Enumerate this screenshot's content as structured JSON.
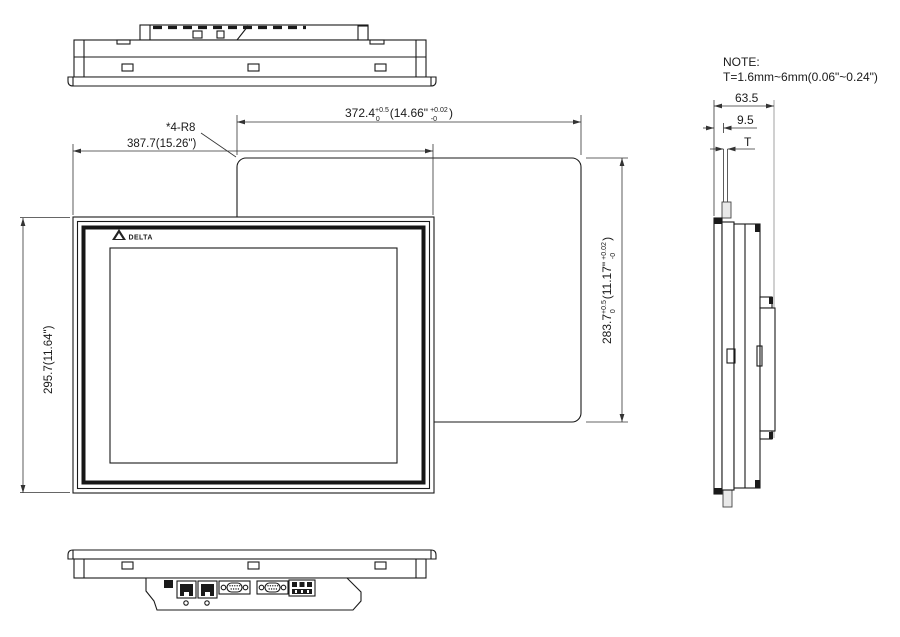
{
  "colors": {
    "line": "#1a1a1a",
    "dim_line": "#333333",
    "background": "#ffffff"
  },
  "drawing": {
    "note": {
      "line1": "NOTE:",
      "line2": "T=1.6mm~6mm(0.06\"~0.24\")"
    },
    "logo": {
      "icon": "delta-triangle-logo",
      "brand": "DELTA"
    },
    "dimensions": {
      "panel_width": "387.7(15.26\")",
      "panel_height": "295.7(11.64\")",
      "corner_radius_note": "*4-R8",
      "depth": "63.5",
      "bezel_depth": "9.5",
      "panel_thickness": "T",
      "cutout_width": {
        "mm": "372.4",
        "mm_tol_plus": "+0.5",
        "mm_tol_minus": "0",
        "inch": "(14.66\"",
        "inch_tol_plus": "+0.02",
        "inch_tol_minus": "-0",
        "close": ")"
      },
      "cutout_height": {
        "mm": "283.7",
        "mm_tol_plus": "+0.5",
        "mm_tol_minus": "0",
        "inch": "(11.17\"",
        "inch_tol_plus": "+0.02",
        "inch_tol_minus": "-0",
        "close": ")"
      }
    }
  }
}
